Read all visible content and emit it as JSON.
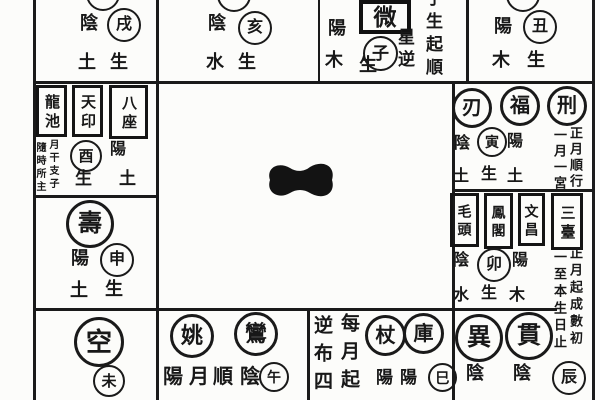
{
  "palette": {
    "paper": "#fcfcfa",
    "ink": "#1a1a1a"
  },
  "top_row": {
    "xu_cell": {
      "polarity": "陰",
      "branch": "戌",
      "element": "土",
      "sheng": "生"
    },
    "hai_cell": {
      "polarity": "陰",
      "branch": "亥",
      "element": "水",
      "sheng": "生"
    },
    "zi_cell": {
      "star_box": "微",
      "polarity": "陽",
      "branch": "子",
      "element": "木",
      "sheng": "生",
      "note_star_col": "星逆",
      "note_order_col": "子生起順"
    },
    "chou_cell": {
      "polarity": "陽",
      "branch": "丑",
      "element": "木",
      "sheng": "生"
    }
  },
  "left_col": {
    "you_cell": {
      "star_boxes": [
        "龍池",
        "天印",
        "八座"
      ],
      "micro_note_right": "月干支子",
      "micro_note_left": "隨時所主",
      "branch": "酉",
      "polarity": "陽",
      "sheng": "生",
      "element": "土"
    },
    "shen_cell": {
      "star_circle": "壽",
      "polarity": "陽",
      "branch": "申",
      "element": "土",
      "sheng": "生"
    },
    "wei_cell": {
      "star_circle": "空",
      "branch": "未"
    }
  },
  "right_col": {
    "yin_cell": {
      "star_circles": [
        "刃",
        "福",
        "刑"
      ],
      "pol_left": "陰",
      "branch": "寅",
      "pol_right": "陽",
      "note_right": "正月順行",
      "note_left": "一月一宮",
      "el_left": "土",
      "sheng": "生",
      "el_right": "土"
    },
    "mao_cell": {
      "star_boxes": [
        "毛頭",
        "鳳閣",
        "文昌",
        "三臺"
      ],
      "pol_left": "陰",
      "branch": "卯",
      "pol_right": "陽",
      "note_right": "正月起成數初",
      "note_left": "一至本生日止",
      "el_left": "水",
      "sheng": "生",
      "el_right": "木"
    },
    "chen_cell": {
      "star_circles": [
        "異",
        "貫"
      ],
      "pol_a": "陰",
      "pol_b": "陰",
      "branch": "辰"
    }
  },
  "bottom_row": {
    "wu_cell": {
      "star_circles": [
        "姚",
        "鸞"
      ],
      "note_chars": [
        "陽",
        "月",
        "順",
        "陰"
      ],
      "branch": "午"
    },
    "si_cell": {
      "note_right": "每月起",
      "note_left": "逆布四",
      "star_circles": [
        "杖",
        "庫"
      ],
      "pol_a": "陽",
      "pol_b": "陽",
      "branch": "巳"
    }
  }
}
